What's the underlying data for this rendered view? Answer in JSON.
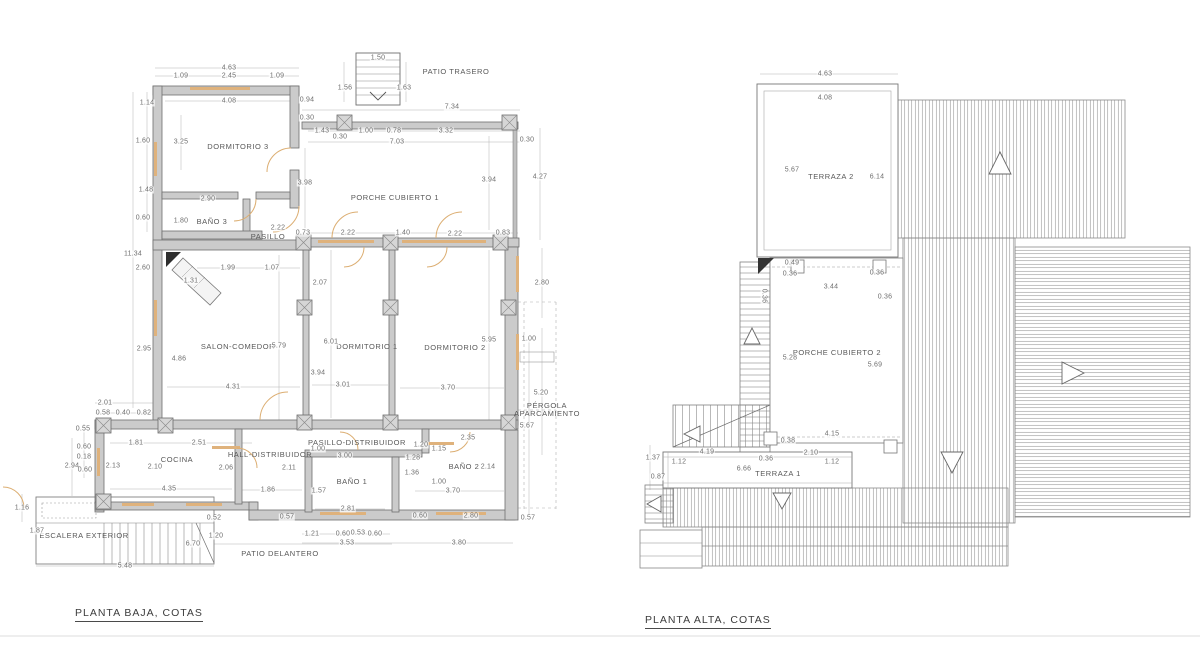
{
  "colors": {
    "wall_fill": "#cbcbcb",
    "line_gray": "#6e6e6e",
    "accent_tan": "#dfb27c",
    "dim_text": "#6e6e6e",
    "title_text": "#3c3c3c"
  },
  "left_plan": {
    "title": "PLANTA BAJA, COTAS",
    "rooms": [
      {
        "label": "PATIO TRASERO",
        "x": 456,
        "y": 72
      },
      {
        "label": "DORMITORIO 3",
        "x": 238,
        "y": 147
      },
      {
        "label": "BAÑO 3",
        "x": 212,
        "y": 222
      },
      {
        "label": "PASILLO",
        "x": 268,
        "y": 237
      },
      {
        "label": "PORCHE CUBIERTO 1",
        "x": 395,
        "y": 198
      },
      {
        "label": "SALON-COMEDOR",
        "x": 238,
        "y": 347
      },
      {
        "label": "DORMITORIO 1",
        "x": 367,
        "y": 347
      },
      {
        "label": "DORMITORIO 2",
        "x": 455,
        "y": 348
      },
      {
        "label": "PÉRGOLA\nAPARCAMIENTO",
        "x": 547,
        "y": 410
      },
      {
        "label": "COCINA",
        "x": 177,
        "y": 460
      },
      {
        "label": "HALL-DISTRIBUIDOR",
        "x": 270,
        "y": 455
      },
      {
        "label": "PASILLO-DISTRIBUIDOR",
        "x": 357,
        "y": 443
      },
      {
        "label": "BAÑO 1",
        "x": 352,
        "y": 482
      },
      {
        "label": "BAÑO 2",
        "x": 464,
        "y": 467
      },
      {
        "label": "ESCALERA EXTERIOR",
        "x": 84,
        "y": 536
      },
      {
        "label": "PATIO DELANTERO",
        "x": 280,
        "y": 554
      }
    ],
    "dims": [
      {
        "v": "1.50",
        "x": 378,
        "y": 58
      },
      {
        "v": "4.63",
        "x": 229,
        "y": 68
      },
      {
        "v": "1.09",
        "x": 181,
        "y": 76
      },
      {
        "v": "2.45",
        "x": 229,
        "y": 76
      },
      {
        "v": "1.09",
        "x": 277,
        "y": 76
      },
      {
        "v": "1.56",
        "x": 345,
        "y": 88
      },
      {
        "v": "1.63",
        "x": 404,
        "y": 88
      },
      {
        "v": "1.14",
        "x": 147,
        "y": 103
      },
      {
        "v": "4.08",
        "x": 229,
        "y": 101
      },
      {
        "v": "0.94",
        "x": 307,
        "y": 100
      },
      {
        "v": "7.34",
        "x": 452,
        "y": 107
      },
      {
        "v": "0.30",
        "x": 307,
        "y": 118
      },
      {
        "v": "1.43",
        "x": 322,
        "y": 131
      },
      {
        "v": "0.30",
        "x": 340,
        "y": 137
      },
      {
        "v": "1.00",
        "x": 366,
        "y": 131
      },
      {
        "v": "0.78",
        "x": 394,
        "y": 131
      },
      {
        "v": "3.32",
        "x": 446,
        "y": 131
      },
      {
        "v": "7.03",
        "x": 397,
        "y": 142
      },
      {
        "v": "0.30",
        "x": 527,
        "y": 140
      },
      {
        "v": "3.25",
        "x": 181,
        "y": 142
      },
      {
        "v": "1.60",
        "x": 143,
        "y": 141
      },
      {
        "v": "3.98",
        "x": 305,
        "y": 183
      },
      {
        "v": "3.94",
        "x": 489,
        "y": 180
      },
      {
        "v": "4.27",
        "x": 540,
        "y": 177
      },
      {
        "v": "1.48",
        "x": 146,
        "y": 190
      },
      {
        "v": "2.90",
        "x": 208,
        "y": 199
      },
      {
        "v": "1.80",
        "x": 181,
        "y": 221
      },
      {
        "v": "0.60",
        "x": 143,
        "y": 218
      },
      {
        "v": "2.22",
        "x": 278,
        "y": 228
      },
      {
        "v": "0.73",
        "x": 303,
        "y": 233
      },
      {
        "v": "2.22",
        "x": 348,
        "y": 233
      },
      {
        "v": "1.40",
        "x": 403,
        "y": 233
      },
      {
        "v": "2.22",
        "x": 455,
        "y": 234
      },
      {
        "v": "0.83",
        "x": 503,
        "y": 233
      },
      {
        "v": "11.34",
        "x": 133,
        "y": 254
      },
      {
        "v": "2.60",
        "x": 143,
        "y": 268
      },
      {
        "v": "1.99",
        "x": 228,
        "y": 268
      },
      {
        "v": "1.07",
        "x": 272,
        "y": 268
      },
      {
        "v": "1.31",
        "x": 191,
        "y": 281
      },
      {
        "v": "2.07",
        "x": 320,
        "y": 283
      },
      {
        "v": "2.80",
        "x": 542,
        "y": 283
      },
      {
        "v": "2.95",
        "x": 144,
        "y": 349
      },
      {
        "v": "4.86",
        "x": 179,
        "y": 359
      },
      {
        "v": "5.79",
        "x": 279,
        "y": 346
      },
      {
        "v": "6.01",
        "x": 331,
        "y": 342
      },
      {
        "v": "5.95",
        "x": 489,
        "y": 340
      },
      {
        "v": "1.00",
        "x": 529,
        "y": 339
      },
      {
        "v": "3.94",
        "x": 318,
        "y": 373
      },
      {
        "v": "4.31",
        "x": 233,
        "y": 387
      },
      {
        "v": "3.01",
        "x": 343,
        "y": 385
      },
      {
        "v": "3.70",
        "x": 448,
        "y": 388
      },
      {
        "v": "5.20",
        "x": 541,
        "y": 393
      },
      {
        "v": "5.67",
        "x": 527,
        "y": 426
      },
      {
        "v": "2.01",
        "x": 105,
        "y": 403
      },
      {
        "v": "0.58",
        "x": 103,
        "y": 413
      },
      {
        "v": "0.40",
        "x": 123,
        "y": 413
      },
      {
        "v": "0.82",
        "x": 144,
        "y": 413
      },
      {
        "v": "0.55",
        "x": 83,
        "y": 429
      },
      {
        "v": "0.60",
        "x": 84,
        "y": 447
      },
      {
        "v": "0.18",
        "x": 84,
        "y": 457
      },
      {
        "v": "2.94",
        "x": 72,
        "y": 466
      },
      {
        "v": "0.60",
        "x": 85,
        "y": 470
      },
      {
        "v": "2.13",
        "x": 113,
        "y": 466
      },
      {
        "v": "1.81",
        "x": 136,
        "y": 443
      },
      {
        "v": "2.51",
        "x": 199,
        "y": 443
      },
      {
        "v": "2.10",
        "x": 155,
        "y": 467
      },
      {
        "v": "2.06",
        "x": 226,
        "y": 468
      },
      {
        "v": "2.11",
        "x": 289,
        "y": 468
      },
      {
        "v": "1.16",
        "x": 22,
        "y": 508
      },
      {
        "v": "4.35",
        "x": 169,
        "y": 489
      },
      {
        "v": "1.86",
        "x": 268,
        "y": 490
      },
      {
        "v": "1.87",
        "x": 37,
        "y": 531
      },
      {
        "v": "0.52",
        "x": 214,
        "y": 518
      },
      {
        "v": "1.20",
        "x": 216,
        "y": 536
      },
      {
        "v": "6.70",
        "x": 193,
        "y": 544
      },
      {
        "v": "5.48",
        "x": 125,
        "y": 566
      },
      {
        "v": "1.00",
        "x": 318,
        "y": 449
      },
      {
        "v": "3.00",
        "x": 345,
        "y": 456
      },
      {
        "v": "1.28",
        "x": 413,
        "y": 458
      },
      {
        "v": "1.20",
        "x": 421,
        "y": 445
      },
      {
        "v": "1.15",
        "x": 439,
        "y": 449
      },
      {
        "v": "2.35",
        "x": 468,
        "y": 438
      },
      {
        "v": "2.14",
        "x": 488,
        "y": 467
      },
      {
        "v": "1.36",
        "x": 412,
        "y": 473
      },
      {
        "v": "1.00",
        "x": 439,
        "y": 482
      },
      {
        "v": "3.70",
        "x": 453,
        "y": 491
      },
      {
        "v": "1.57",
        "x": 319,
        "y": 491
      },
      {
        "v": "2.81",
        "x": 348,
        "y": 509
      },
      {
        "v": "0.60",
        "x": 420,
        "y": 516
      },
      {
        "v": "2.80",
        "x": 471,
        "y": 516
      },
      {
        "v": "0.57",
        "x": 528,
        "y": 518
      },
      {
        "v": "0.57",
        "x": 287,
        "y": 517
      },
      {
        "v": "1.21",
        "x": 312,
        "y": 534
      },
      {
        "v": "0.60",
        "x": 343,
        "y": 534
      },
      {
        "v": "0.53",
        "x": 358,
        "y": 533
      },
      {
        "v": "0.60",
        "x": 375,
        "y": 534
      },
      {
        "v": "3.53",
        "x": 347,
        "y": 543
      },
      {
        "v": "3.80",
        "x": 459,
        "y": 543
      }
    ]
  },
  "right_plan": {
    "title": "PLANTA ALTA, COTAS",
    "rooms": [
      {
        "label": "TERRAZA 2",
        "x": 831,
        "y": 177
      },
      {
        "label": "PORCHE CUBIERTO 2",
        "x": 837,
        "y": 353
      },
      {
        "label": "TERRAZA 1",
        "x": 778,
        "y": 474
      }
    ],
    "dims": [
      {
        "v": "4.63",
        "x": 825,
        "y": 74
      },
      {
        "v": "4.08",
        "x": 825,
        "y": 98
      },
      {
        "v": "5.67",
        "x": 792,
        "y": 170
      },
      {
        "v": "6.14",
        "x": 877,
        "y": 177
      },
      {
        "v": "0.49",
        "x": 792,
        "y": 263
      },
      {
        "v": "0.36",
        "x": 790,
        "y": 274
      },
      {
        "v": "0.36",
        "x": 877,
        "y": 273
      },
      {
        "v": "3.44",
        "x": 831,
        "y": 287
      },
      {
        "v": "0.36",
        "x": 764,
        "y": 296,
        "r": 90
      },
      {
        "v": "0.36",
        "x": 885,
        "y": 297
      },
      {
        "v": "5.28",
        "x": 790,
        "y": 358
      },
      {
        "v": "5.69",
        "x": 875,
        "y": 365
      },
      {
        "v": "4.15",
        "x": 832,
        "y": 434
      },
      {
        "v": "0.38",
        "x": 788,
        "y": 441
      },
      {
        "v": "4.19",
        "x": 707,
        "y": 452
      },
      {
        "v": "2.10",
        "x": 811,
        "y": 453
      },
      {
        "v": "0.36",
        "x": 766,
        "y": 459
      },
      {
        "v": "1.12",
        "x": 679,
        "y": 462
      },
      {
        "v": "1.12",
        "x": 832,
        "y": 462
      },
      {
        "v": "6.66",
        "x": 744,
        "y": 469
      },
      {
        "v": "1.37",
        "x": 653,
        "y": 458
      },
      {
        "v": "0.87",
        "x": 658,
        "y": 477
      }
    ]
  }
}
